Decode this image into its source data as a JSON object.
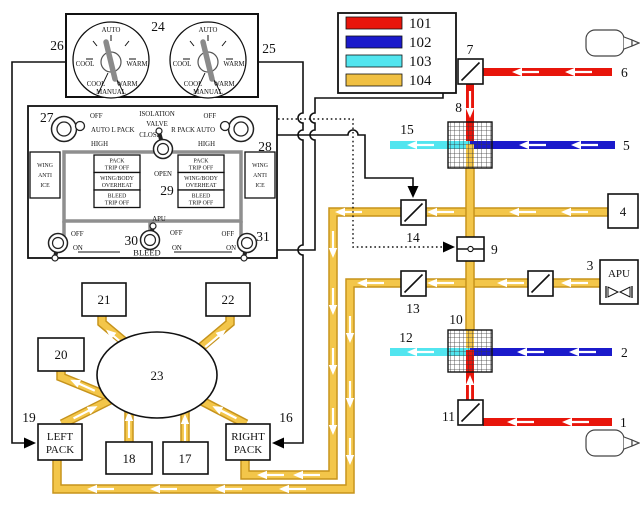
{
  "colors": {
    "red": "#e8150b",
    "blue": "#1b1acb",
    "cyan": "#52e5ef",
    "amber_fill": "#f3c64a",
    "amber_border": "#c6931b",
    "panel_gray": "#8f8f8f",
    "knob_gray": "#808080"
  },
  "legend": {
    "items": [
      {
        "label": "101",
        "color": "#e8150b"
      },
      {
        "label": "102",
        "color": "#1b1acb"
      },
      {
        "label": "103",
        "color": "#52e5ef"
      },
      {
        "label": "104",
        "color": "#f0c043"
      }
    ]
  },
  "callouts": {
    "1": "1",
    "2": "2",
    "3": "3",
    "4": "4",
    "5": "5",
    "6": "6",
    "7": "7",
    "8": "8",
    "9": "9",
    "10": "10",
    "11": "11",
    "12": "12",
    "13": "13",
    "14": "14",
    "15": "15",
    "16": "16",
    "17": "17",
    "18": "18",
    "19": "19",
    "20": "20",
    "21": "21",
    "22": "22",
    "23": "23",
    "24": "24",
    "25": "25",
    "26": "26",
    "27": "27",
    "28": "28",
    "29": "29",
    "30": "30",
    "31": "31"
  },
  "temp_panel": {
    "auto": "AUTO",
    "cool": "COOL",
    "warm": "WARM",
    "manual": "MANUAL"
  },
  "bleed_panel": {
    "isolation": "ISOLATION",
    "valve": "VALVE",
    "close": "CLOSE",
    "open": "OPEN",
    "off": "OFF",
    "on": "ON",
    "high": "HIGH",
    "auto_l_pack": "AUTO L PACK",
    "r_pack_auto": "R PACK AUTO",
    "wing": "WING",
    "anti": "ANTI",
    "ice": "ICE",
    "apu": "APU",
    "bleed": "BLEED",
    "ann_pack": "PACK",
    "ann_trip_off": "TRIP OFF",
    "ann_wing_body": "WING/BODY",
    "ann_overheat": "OVERHEAT",
    "ann_bleed": "BLEED"
  },
  "packs": {
    "left1": "LEFT",
    "left2": "PACK",
    "right1": "RIGHT",
    "right2": "PACK"
  },
  "apu_label": "APU"
}
